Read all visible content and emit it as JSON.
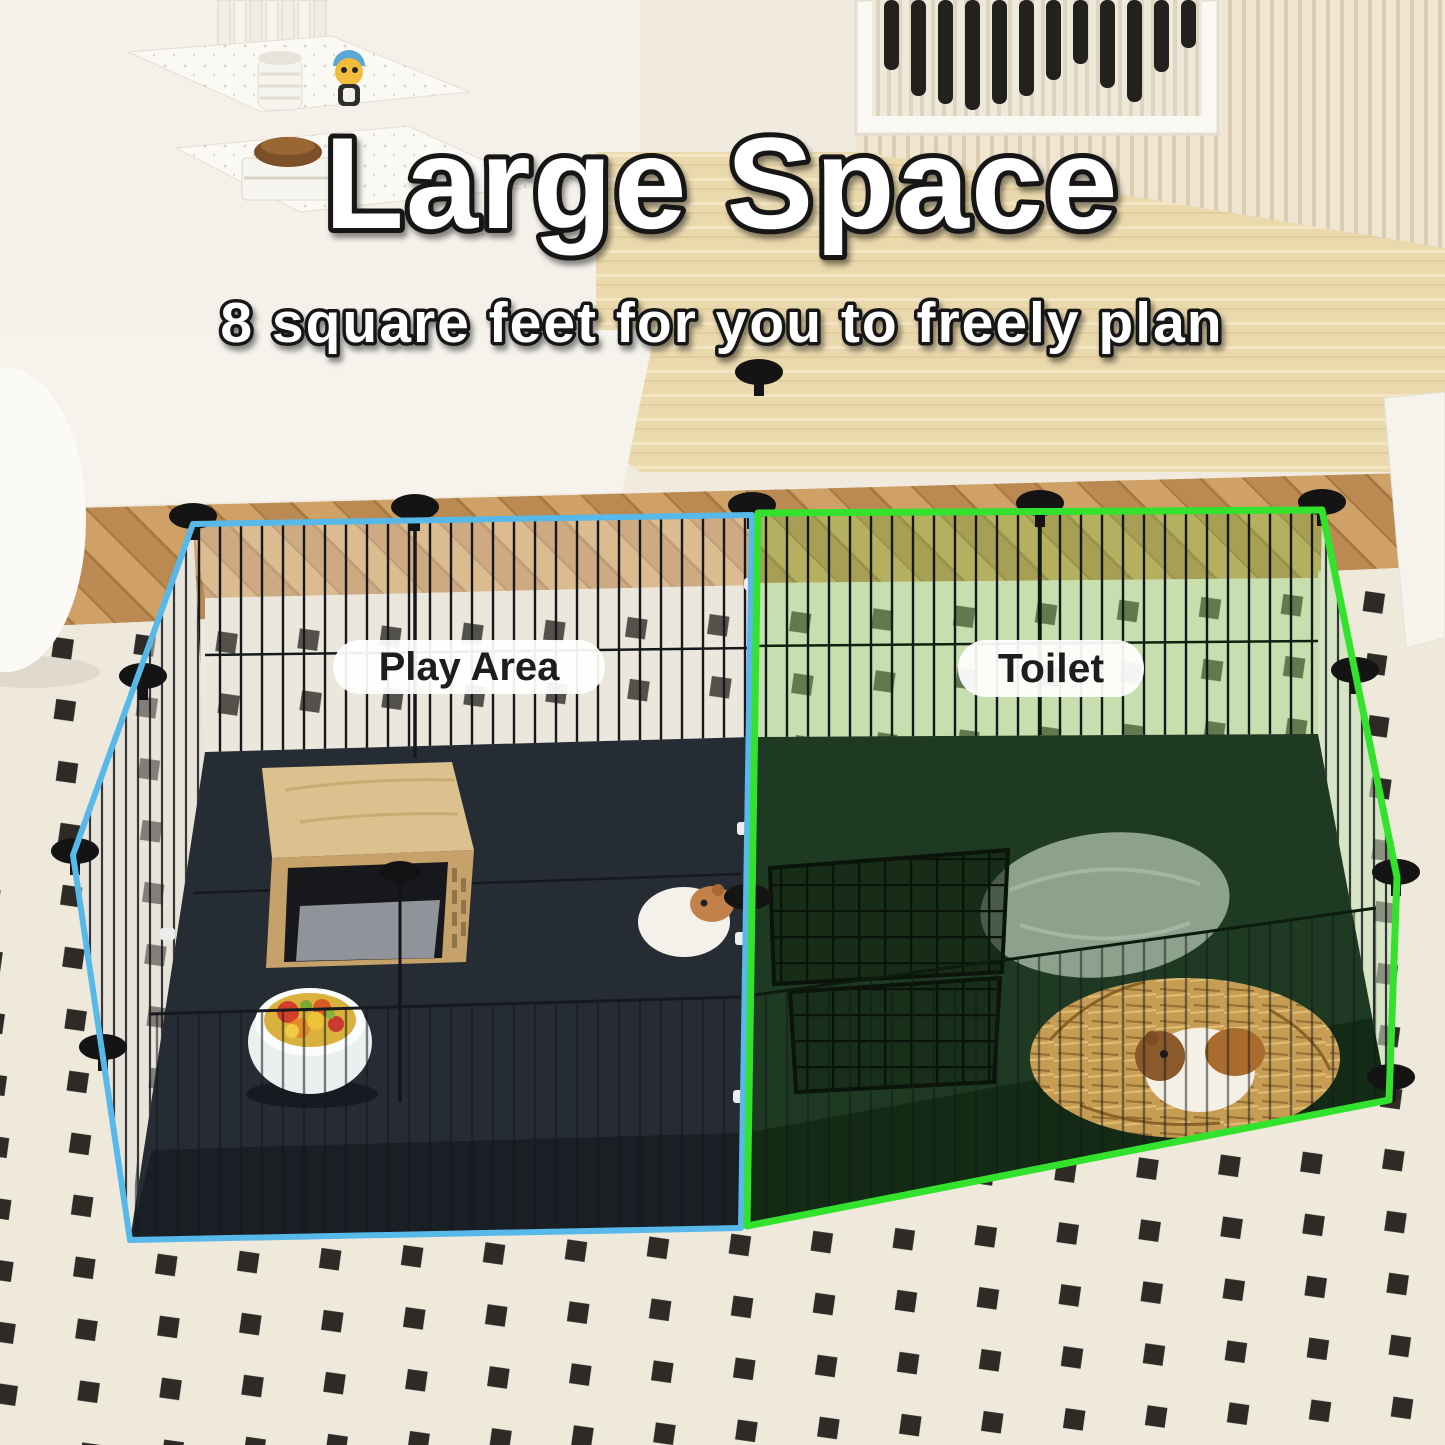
{
  "heading": {
    "title": "Large Space",
    "subtitle": "8 square feet for you to freely plan",
    "text_color": "#ffffff",
    "outline_color": "#151515"
  },
  "areas": {
    "play": {
      "label": "Play Area",
      "outline_color": "#56b9e9"
    },
    "toilet": {
      "label": "Toilet",
      "outline_color": "#33e22c"
    }
  },
  "label_pill": {
    "background": "#ffffff",
    "text_color": "#1d1d1d"
  },
  "scene": {
    "setting": "living room with corner shelf, striped wall art, slat panel, wood sideboard, herringbone floor, cream rug with black squares",
    "pen": "black wire-grid pet playpen with dark base tray, split into two highlighted sections",
    "play_area_items": [
      "wooden hideout with grey cushion",
      "bowl of vegetables",
      "guinea pig"
    ],
    "toilet_items": [
      "grey pee pad",
      "black wire gate",
      "hay pile",
      "guinea pig"
    ]
  }
}
